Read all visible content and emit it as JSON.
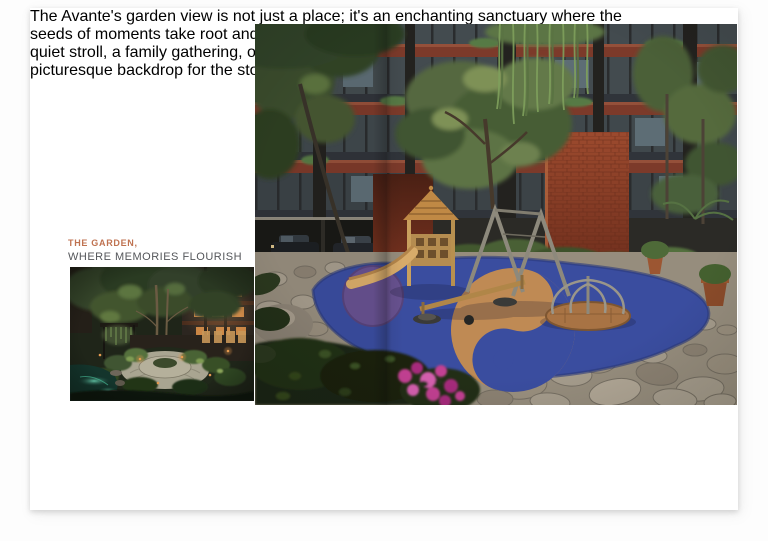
{
  "left_column": {
    "heading": "THE GARDEN,",
    "subheading": "WHERE MEMORIES FLOURISH",
    "body_lines": [
      "The Avante's garden view is not just a place; it's an enchanting sanctuary where the",
      "seeds of moments take root and blossom into beautiful recollection. Whether it's a",
      "quiet stroll, a family gathering, or a tranquil moment of solitude, The Avante offers a",
      "picturesque backdrop for the stories of your life."
    ]
  },
  "colors": {
    "heading_accent": "#bf7250",
    "subheading_text": "#54565a",
    "body_text": "#8d8d8d",
    "play_surface_blue": "#3a4d9f",
    "play_swirl_tan": "#bf8a54",
    "play_circle_purple": "#67518f",
    "brick_wall_red": "#8a3e27",
    "page_background": "#ffffff"
  }
}
